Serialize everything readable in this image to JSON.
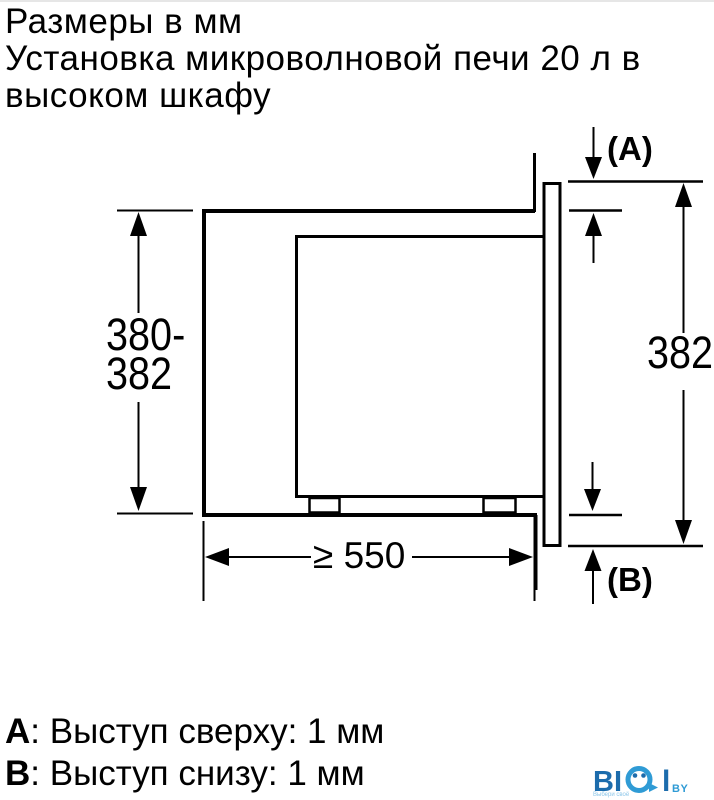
{
  "title": {
    "lines": [
      "Размеры в мм",
      "Установка микроволновой печи 20 л в",
      "высоком шкафу"
    ]
  },
  "diagram": {
    "dim_niche_height": {
      "line1": "380-",
      "line2": "382"
    },
    "dim_front_height": "382",
    "dim_depth": "≥ 550",
    "label_top": "(A)",
    "label_bottom": "(B)"
  },
  "legend": {
    "items": [
      {
        "key": "A",
        "text": ": Выступ сверху: 1 мм"
      },
      {
        "key": "B",
        "text": ": Выступ снизу: 1 мм"
      }
    ]
  },
  "logo": {
    "letters_bi": "BI",
    "letter_l": "l",
    "suffix": "BY",
    "tagline": "Выбери своё"
  },
  "colors": {
    "ink": "#000000",
    "logo_dark": "#1c6cac",
    "logo_light": "#2f9bd5",
    "logo_tagline": "#8cc6e9"
  }
}
